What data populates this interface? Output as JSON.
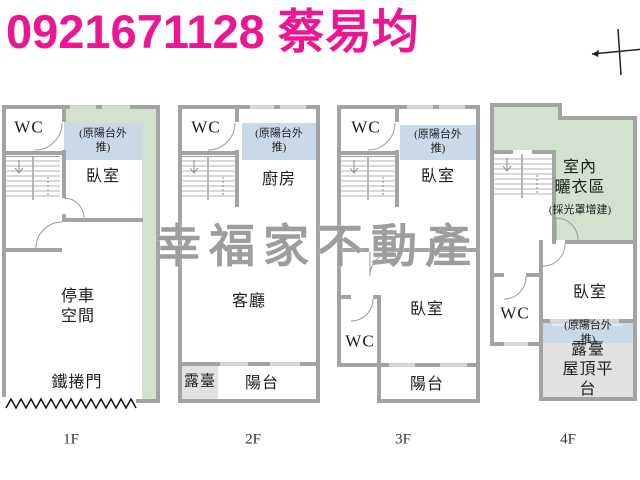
{
  "header": {
    "phone": "0921671128",
    "agent": "蔡易均",
    "color": "#ec1592"
  },
  "watermark": {
    "text": "幸福家不動產",
    "color": "#9d9d9d"
  },
  "colors": {
    "wall_gray": "#a3a3a3",
    "balcony_blue": "#c9d9e8",
    "laundry_green": "#d3e1cf",
    "terrace_gray": "#e2e2e2",
    "stair_line": "#b3b3b3"
  },
  "icons": {
    "compass": "north-cross-marker"
  },
  "floors": [
    {
      "label": "1F",
      "rooms": {
        "wc": "WC",
        "balcony_pushed": "(原陽台外推)",
        "bedroom": "臥室",
        "parking": "停車\n空間",
        "roller_door": "鐵捲門"
      }
    },
    {
      "label": "2F",
      "rooms": {
        "wc": "WC",
        "balcony_pushed": "(原陽台外推)",
        "kitchen": "廚房",
        "living": "客廳",
        "terrace": "露臺",
        "balcony": "陽台"
      }
    },
    {
      "label": "3F",
      "rooms": {
        "wc_top": "WC",
        "balcony_pushed": "(原陽台外推)",
        "bedroom_top": "臥室",
        "bedroom": "臥室",
        "wc": "WC",
        "balcony": "陽台"
      }
    },
    {
      "label": "4F",
      "rooms": {
        "laundry": "室內\n曬衣區",
        "laundry_note": "(採光罩增建)",
        "wc": "WC",
        "bedroom": "臥室",
        "balcony_pushed": "(原陽台外推)",
        "roof_terrace": "露臺\n屋頂平台"
      }
    }
  ]
}
